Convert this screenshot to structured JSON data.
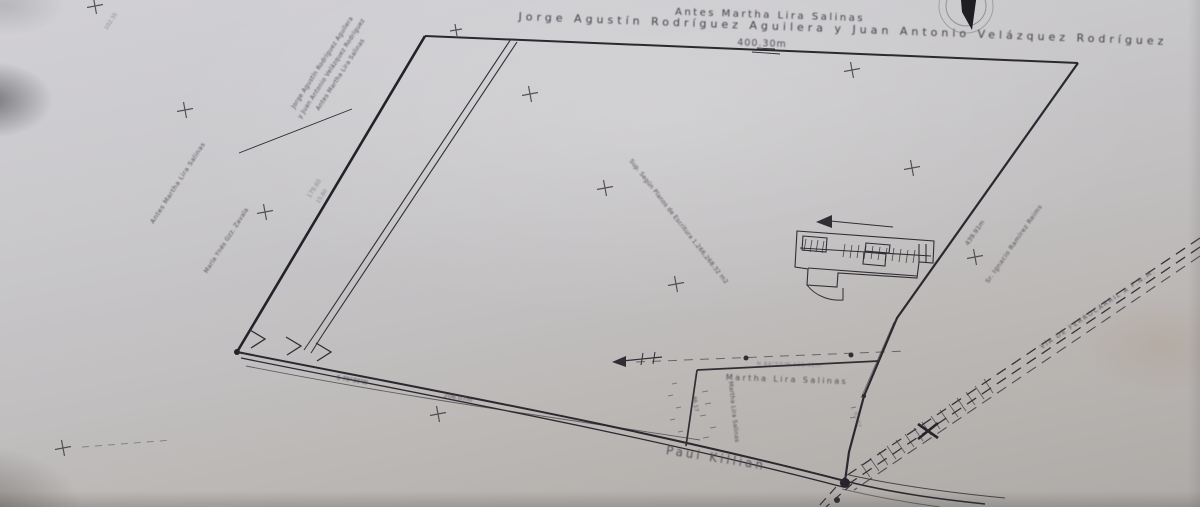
{
  "colors": {
    "ink": "#2f2e34",
    "heavy_ink": "#26252b",
    "label_text": "#4f4c54",
    "paper": "#c6c4c6"
  },
  "labels": {
    "top_prev_owner": "Antes Martha Lira Salinas",
    "top_owner": "Jorge Agustín Rodríguez Aguilera y Juan Antonio Velázquez Rodríguez",
    "top_dim": "400.30m",
    "tl_line1": "Jorge Agustín Rodríguez Aguilera",
    "tl_line2": "y Juan Antonio Velázquez Rodríguez",
    "tl_line3": "Antes Martha Lira Salinas",
    "left_neighbor_a": "Antes Martha Lira Salinas",
    "left_neighbor_b": "María Ynés Gzz. Zavala",
    "left_dim_a": "179.60",
    "left_dim_b": "15.80",
    "area_note": "Sup. Según Planos de Escritura 1,266,268.32 m2",
    "right_dim": "439.91m",
    "right_neighbor": "Sr. Ignacio Ramírez Reims",
    "railroad": "VÍA DE FERROCARRIL A F.N.M.",
    "parcel_bearing": "N 84°50'W  101.42m",
    "parcel_owner": "Martha Lira Salinas",
    "parcel_owner_side": "Martha Lira Salinas",
    "parcel_dim_left": "46.17",
    "parcel_dim_right": "61.57",
    "street": "Paul Killian",
    "road_bearing": "S 79°30'W",
    "road_dim": "206.07m",
    "corner_coord": "102.35"
  }
}
